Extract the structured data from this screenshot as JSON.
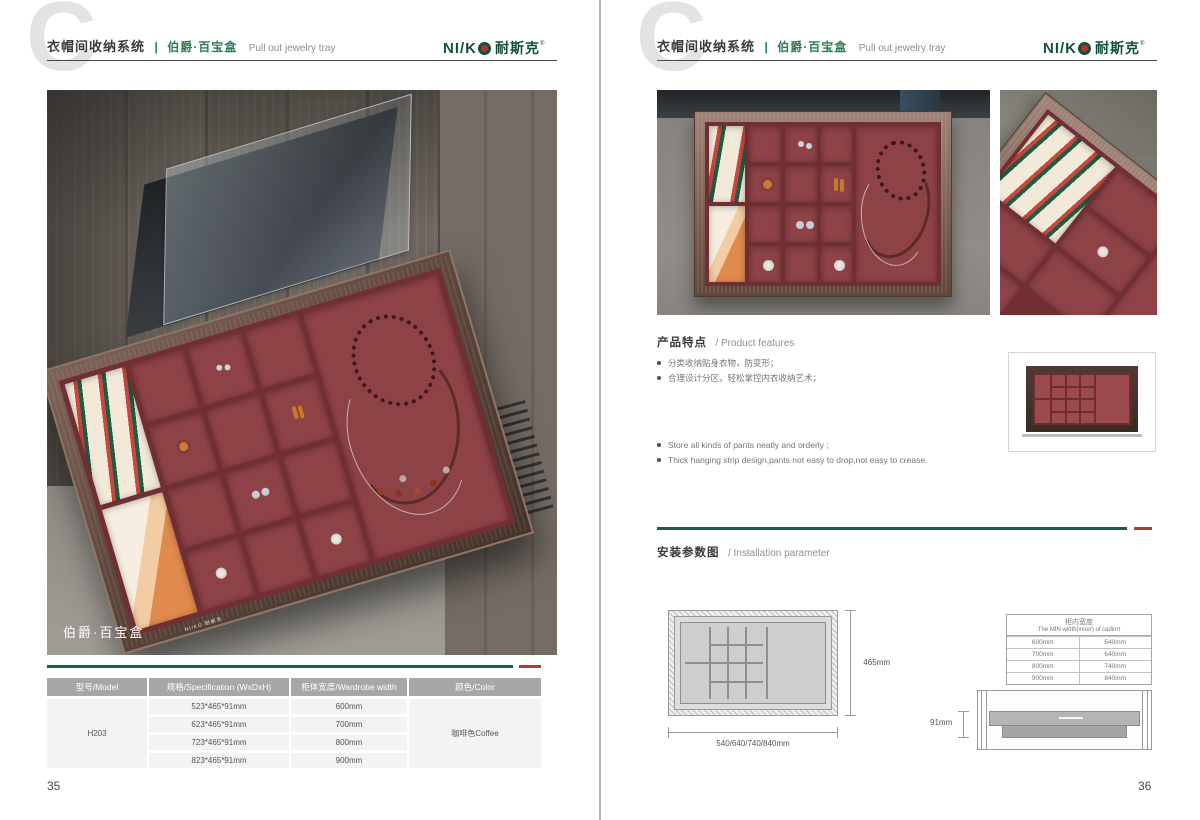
{
  "header": {
    "watermark": "C",
    "title_zh": "衣帽间收纳系统",
    "divider": "|",
    "product_zh": "伯爵·百宝盒",
    "product_en": "Pull out jewelry tray",
    "logo": {
      "latin": "NI/K",
      "cn": "耐斯克",
      "reg": "®"
    }
  },
  "left_page": {
    "page_number": "35",
    "photo": {
      "label": "伯爵·百宝盒",
      "brand": "NI/KO 耐斯克"
    },
    "table": {
      "headers": [
        "型号/Model",
        "规格/Specification (WxDxH)",
        "柜体宽度/Wardrobe width",
        "颜色/Color"
      ],
      "model": "H203",
      "color": "咖啡色Coffee",
      "rows": [
        {
          "spec": "523*465*91mm",
          "width": "600mm"
        },
        {
          "spec": "623*465*91mm",
          "width": "700mm"
        },
        {
          "spec": "723*465*91mm",
          "width": "800mm"
        },
        {
          "spec": "823*465*91mm",
          "width": "900mm"
        }
      ]
    }
  },
  "right_page": {
    "page_number": "36",
    "features": {
      "title_zh": "产品特点",
      "title_en": "/ Product features",
      "zh": [
        "分类收纳贴身衣物，防变形；",
        "合理设计分区，轻松掌控内衣收纳艺术；"
      ],
      "en": [
        "Store all kinds of pants neatly and orderly ;",
        "Thick hanging strip design,pants not easy to drop,not easy to crease."
      ]
    },
    "installation": {
      "title_zh": "安装参数图",
      "title_en": "/ Installation parameter",
      "topview": {
        "depth": "465mm",
        "widths": "540/640/740/840mm"
      },
      "width_table": {
        "title_zh": "柜内宽度",
        "title_en": "The MIN width(inner) of cadinrt",
        "rows": [
          [
            "600mm",
            "540mm"
          ],
          [
            "700mm",
            "640mm"
          ],
          [
            "800mm",
            "740mm"
          ],
          [
            "900mm",
            "840mm"
          ]
        ]
      },
      "sideview": {
        "height": "91mm"
      }
    }
  },
  "colors": {
    "accent_green": "#1d5b45",
    "accent_red": "#b23b32",
    "logo_green": "#14503a",
    "product_green": "#2e7d52",
    "maroon_cell": "#8d4246",
    "maroon_wall": "#722f33",
    "table_header_gray": "#a7a7a7"
  }
}
